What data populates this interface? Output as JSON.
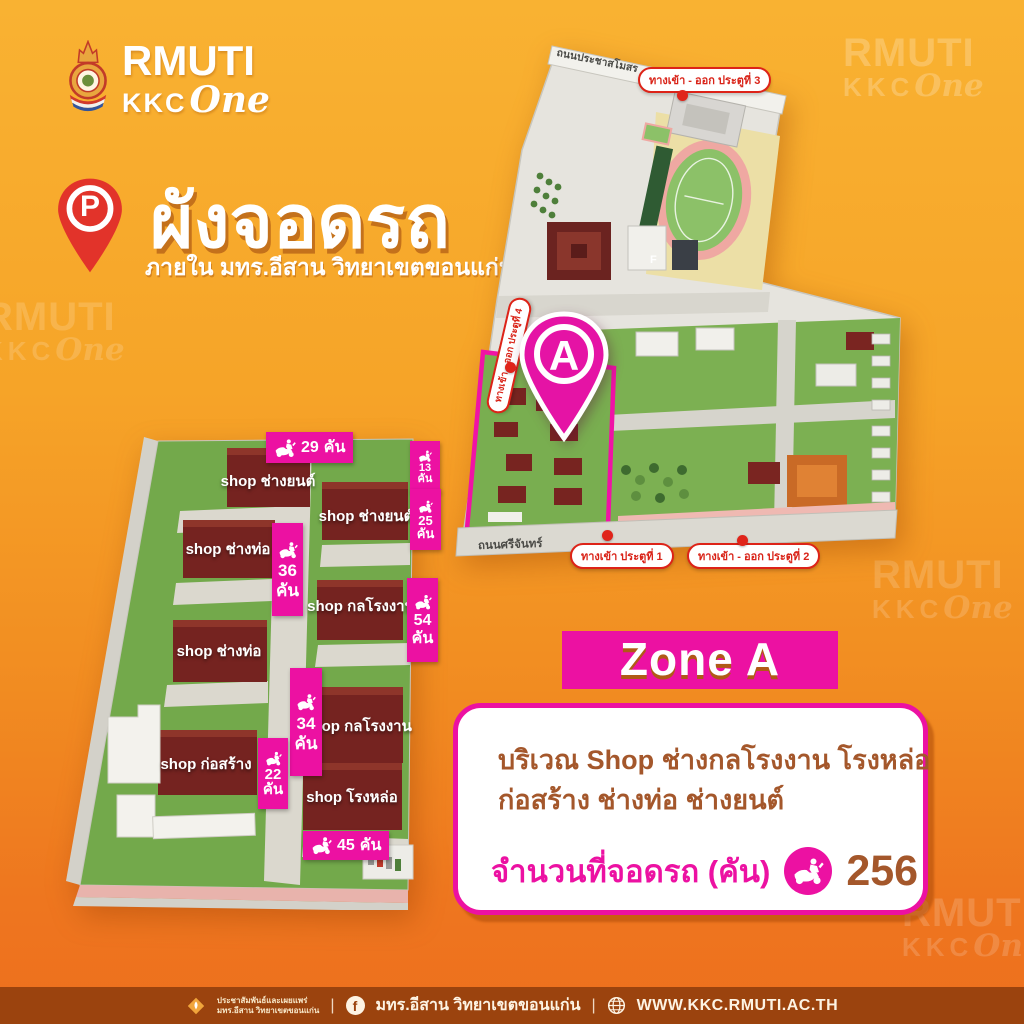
{
  "colors": {
    "bg_top": "#F9B232",
    "bg_bottom": "#ED6F1E",
    "magenta": "#EC11A2",
    "red": "#DD2318",
    "brown_text": "#A4572B",
    "footer_bg": "#9B430E",
    "building": "#752320",
    "grass": "#73A94B"
  },
  "brand": {
    "line1": "RMUTI",
    "line2": "KKC",
    "line3": "One"
  },
  "watermark": {
    "line1": "RMUTI",
    "kkc": "KKC",
    "one": "One"
  },
  "header": {
    "pin_letter": "P",
    "title": "ผังจอดรถ",
    "subtitle": "ภายใน มทร.อีสาน วิทยาเขตขอนแก่น"
  },
  "campus_map": {
    "road_top": "ถนนประชาสโมสร",
    "road_bottom": "ถนนศรีจันทร์",
    "gate3": "ทางเข้า - ออก ประตูที่ 3",
    "gate4": "ทางเข้า - ออก ประตูที่ 4",
    "gate1": "ทางเข้า ประตูที่ 1",
    "gate2": "ทางเข้า - ออก ประตูที่ 2",
    "building_f": "F",
    "zone_pin": "A"
  },
  "zone_map": {
    "buildings": [
      {
        "name": "shop ช่างยนต์"
      },
      {
        "name": "shop ช่างยนต์"
      },
      {
        "name": "shop ช่างท่อ"
      },
      {
        "name": "shop กลโรงงาน"
      },
      {
        "name": "shop ช่างท่อ"
      },
      {
        "name": "shop กลโรงงาน"
      },
      {
        "name": "shop ก่อสร้าง"
      },
      {
        "name": "shop โรงหล่อ"
      }
    ],
    "counts": [
      {
        "value": "29",
        "unit": "คัน"
      },
      {
        "value": "13",
        "unit": "คัน"
      },
      {
        "value": "25",
        "unit": "คัน"
      },
      {
        "value": "36",
        "unit": "คัน"
      },
      {
        "value": "54",
        "unit": "คัน"
      },
      {
        "value": "34",
        "unit": "คัน"
      },
      {
        "value": "22",
        "unit": "คัน"
      },
      {
        "value": "45",
        "unit": "คัน"
      }
    ]
  },
  "zone_panel": {
    "zone_label": "Zone A",
    "desc_line1": "บริเวณ Shop ช่างกลโรงงาน  โรงหล่อ",
    "desc_line2": "ก่อสร้าง ช่างท่อ ช่างยนต์",
    "total_label": "จำนวนที่จอดรถ (คัน)",
    "total_value": "256"
  },
  "footer": {
    "pr_line1": "ประชาสัมพันธ์และเผยแพร่",
    "pr_line2": "มทร.อีสาน วิทยาเขตขอนแก่น",
    "facebook_label": "มทร.อีสาน วิทยาเขตขอนแก่น",
    "website": "WWW.KKC.RMUTI.AC.TH",
    "separator": "|"
  }
}
